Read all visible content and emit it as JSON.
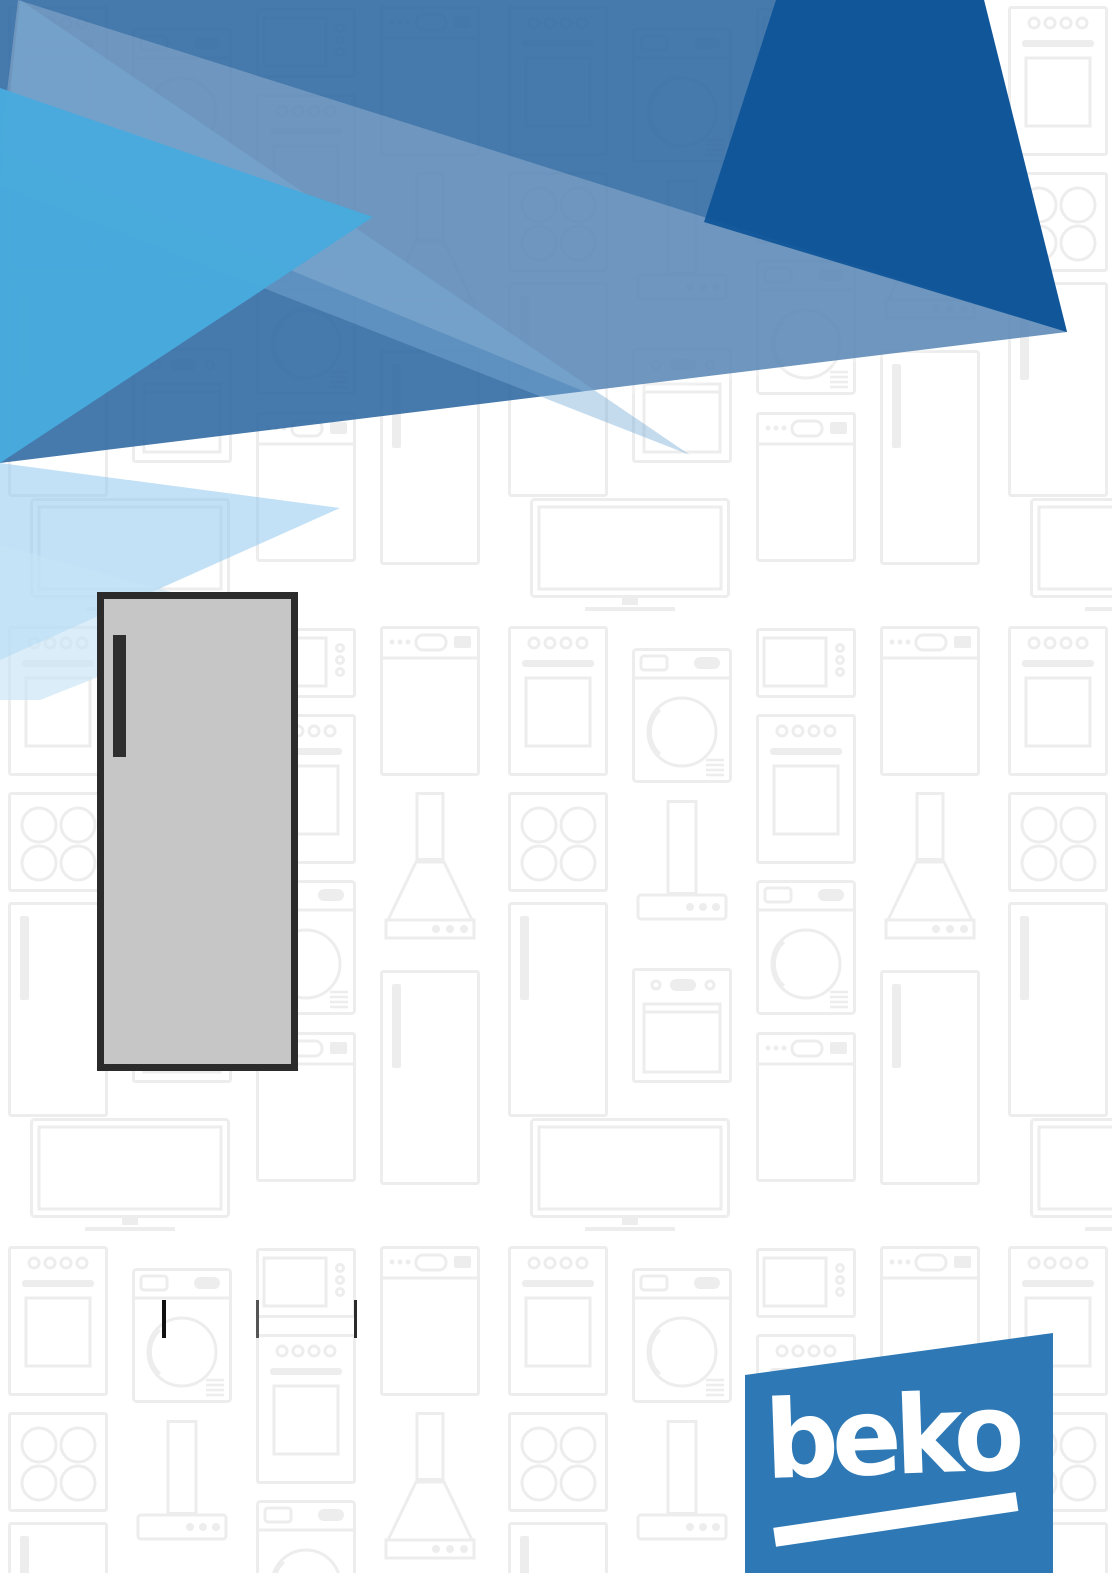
{
  "document": {
    "type": "appliance-manual-front-cover",
    "brand": "beko",
    "visible_text": [
      "beko"
    ]
  },
  "logo": {
    "text": "beko",
    "background_color": "#2e79b5",
    "text_color": "#ffffff",
    "underline_bar_color": "#ffffff"
  },
  "hero_illustration": {
    "name": "upright-freezer",
    "description": "single-door upright freezer, front view, dark handle on upper left",
    "body_color": "#c6c6c6",
    "outline_color": "#2b2b2b",
    "handle_color": "#2e2e2e"
  },
  "divider_marks": {
    "count": 3,
    "colors": [
      "#111111",
      "#555555",
      "#2b2b2b"
    ]
  },
  "header_graphic": {
    "description": "overlapping translucent blue triangles banner",
    "colors": {
      "base": "rgba(38,98,158,0.85)",
      "wedge_shallow": "rgba(255,255,255,0.22)",
      "wedge_steep": "rgba(125,175,218,0.45)",
      "cyan": "rgba(72,170,221,0.97)",
      "dark": "rgba(13,84,152,0.93)",
      "pale_a": "rgba(143,200,238,0.55)",
      "pale_b": "rgba(198,228,246,0.65)"
    }
  },
  "background_pattern": {
    "stroke_color": "#ededed",
    "background_color": "#ffffff",
    "icons": [
      "washing-machine",
      "freestanding-oven",
      "built-in-oven",
      "cooktop",
      "television",
      "microwave",
      "range-hood-chimney",
      "range-hood-pyramid",
      "dishwasher",
      "refrigerator"
    ]
  }
}
